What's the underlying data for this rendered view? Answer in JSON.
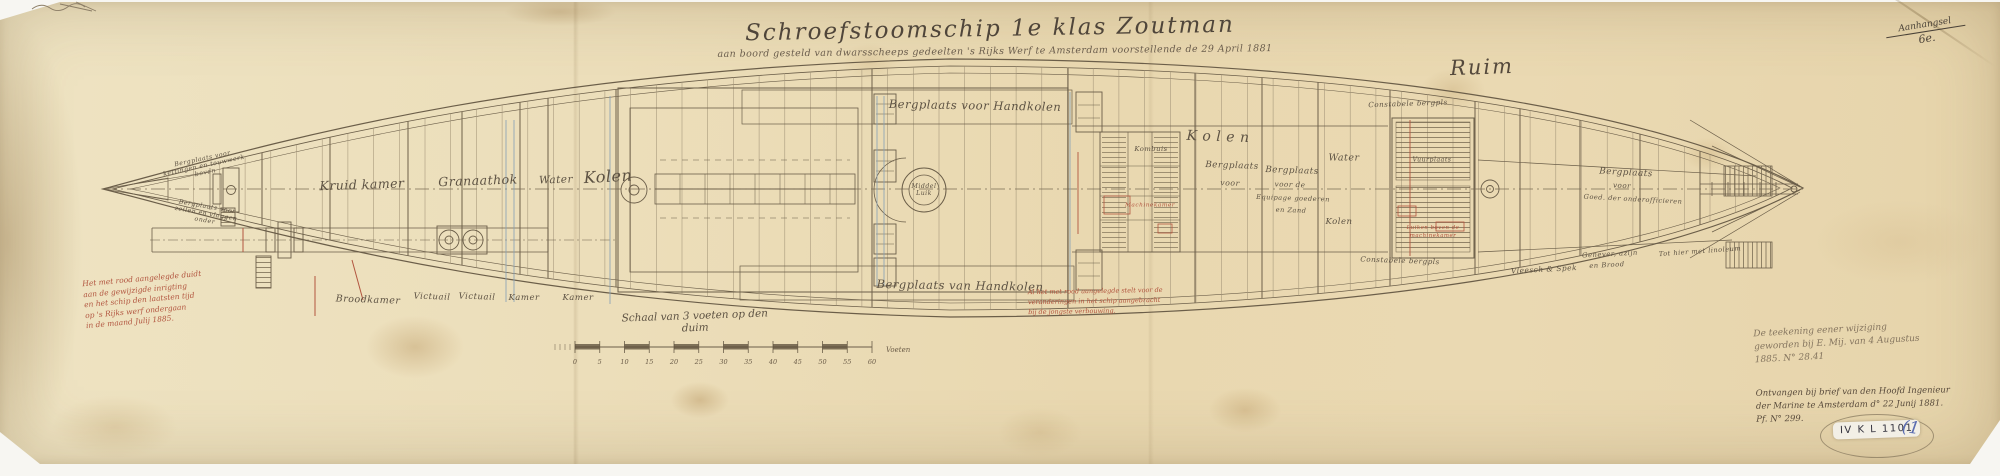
{
  "header": {
    "title": "Schroefstoomschip 1e klas Zoutman",
    "subtitle": "aan boord gesteld van dwarsscheeps gedeelten 's Rijks Werf te Amsterdam voorstellende de 29 April 1881",
    "corner_note": [
      "Aanhangsel",
      "6e."
    ],
    "hold_label": "Ruim"
  },
  "plan": {
    "labels": [
      {
        "text": "Bergplaats voor\nkettingen en touwwerk\nboven",
        "x": 204,
        "y": 166,
        "s": 6.2,
        "r": -12
      },
      {
        "text": "Bergplaats voor\nzeilen en vlaggen\nonder",
        "x": 206,
        "y": 214,
        "s": 6.2,
        "r": 10
      },
      {
        "text": "Kruid kamer",
        "x": 362,
        "y": 185,
        "s": 12.5,
        "r": -2
      },
      {
        "text": "Granaathok",
        "x": 478,
        "y": 181,
        "s": 12.5,
        "r": -2
      },
      {
        "text": "Water",
        "x": 556,
        "y": 180,
        "s": 10.5,
        "r": -2
      },
      {
        "text": "Kolen",
        "x": 608,
        "y": 177,
        "s": 16,
        "r": -3
      },
      {
        "text": "Broodkamer",
        "x": 368,
        "y": 301,
        "s": 9.5,
        "r": 2
      },
      {
        "text": "Victuail",
        "x": 432,
        "y": 298,
        "s": 8.5,
        "r": 2
      },
      {
        "text": "Victuail",
        "x": 477,
        "y": 298,
        "s": 8.5,
        "r": 2
      },
      {
        "text": "Kamer",
        "x": 524,
        "y": 299,
        "s": 8.5,
        "r": 0
      },
      {
        "text": "Kamer",
        "x": 578,
        "y": 299,
        "s": 8.5,
        "r": 0
      },
      {
        "text": "Bergplaats voor Handkolen",
        "x": 975,
        "y": 106,
        "s": 11.5,
        "r": 1
      },
      {
        "text": "Bergplaats van Handkolen",
        "x": 960,
        "y": 286,
        "s": 11.5,
        "r": 1
      },
      {
        "text": "Middel\nLuik",
        "x": 924,
        "y": 190,
        "s": 6.2,
        "r": 0
      },
      {
        "text": "K o l e n",
        "x": 1218,
        "y": 137,
        "s": 14,
        "r": 2
      },
      {
        "text": "Water",
        "x": 1344,
        "y": 159,
        "s": 9.5,
        "r": 0
      },
      {
        "text": "Kolen",
        "x": 1339,
        "y": 223,
        "s": 8.5,
        "r": 0
      },
      {
        "text": "Constabele bergpls",
        "x": 1408,
        "y": 104,
        "s": 7.2,
        "r": -2
      },
      {
        "text": "Constabele bergpls",
        "x": 1400,
        "y": 261,
        "s": 7.2,
        "r": 2
      },
      {
        "text": "Kombuis",
        "x": 1151,
        "y": 150,
        "s": 6.8,
        "r": 0
      },
      {
        "text": "Machinekamer",
        "x": 1150,
        "y": 206,
        "s": 5.8,
        "r": 0,
        "c": "#b2553f"
      },
      {
        "text": "Bergplaats",
        "x": 1232,
        "y": 166,
        "s": 8.8,
        "r": 2
      },
      {
        "text": "voor",
        "x": 1230,
        "y": 184,
        "s": 7.8,
        "r": 2
      },
      {
        "text": "Bergplaats",
        "x": 1292,
        "y": 171,
        "s": 8.8,
        "r": 2
      },
      {
        "text": "voor de",
        "x": 1290,
        "y": 185,
        "s": 7.2,
        "r": 2
      },
      {
        "text": "Equipage goederen",
        "x": 1293,
        "y": 199,
        "s": 6.6,
        "r": 2
      },
      {
        "text": "en Zand",
        "x": 1291,
        "y": 211,
        "s": 6.6,
        "r": 2
      },
      {
        "text": "Bergplaats",
        "x": 1626,
        "y": 173,
        "s": 8.8,
        "r": 3
      },
      {
        "text": "voor",
        "x": 1622,
        "y": 186,
        "s": 7.2,
        "r": 3
      },
      {
        "text": "Goed. der onderofficieren",
        "x": 1633,
        "y": 200,
        "s": 6.6,
        "r": 3
      },
      {
        "text": "Genever, azijn",
        "x": 1610,
        "y": 255,
        "s": 6.8,
        "r": -3
      },
      {
        "text": "en Brood",
        "x": 1607,
        "y": 266,
        "s": 6.8,
        "r": -3
      },
      {
        "text": "Vleesch & Spek",
        "x": 1544,
        "y": 270,
        "s": 7.4,
        "r": -3
      },
      {
        "text": "Tot hier met linoleum",
        "x": 1700,
        "y": 252,
        "s": 6.6,
        "r": -4
      },
      {
        "text": "Vuurplaats",
        "x": 1432,
        "y": 160,
        "s": 6.2,
        "r": 0
      },
      {
        "text": "Luiken boven de",
        "x": 1433,
        "y": 228,
        "s": 5.4,
        "r": 0,
        "c": "#b2553f"
      },
      {
        "text": "machinekamer",
        "x": 1433,
        "y": 236,
        "s": 5.4,
        "r": 0,
        "c": "#b2553f"
      }
    ]
  },
  "notes": {
    "left_red": {
      "lines": [
        "Het met rood aangelegde duidt",
        "aan de gewijzigde inrigting",
        "en het schip den laatsten tijd",
        "op 's Rijks werf ondergaan",
        "in de maand Julij 1885."
      ]
    },
    "center_red": {
      "lines": [
        "Al het met rood aangelegde stelt voor de",
        "veranderingen in het schip aangebracht",
        "bij de jongste verbouwing."
      ]
    },
    "right_pencil": {
      "lines": [
        "De teekening eener wijziging",
        "geworden bij E. Mij. van 4 Augustus",
        "1885.   N° 28.41"
      ]
    },
    "right_ink": {
      "lines": [
        "Ontvangen bij brief van den Hoofd Ingenieur",
        "der Marine te Amsterdam  d° 22 Junij 1881.",
        "Pf.   N° 299."
      ]
    },
    "sticker": "IV K L 1101",
    "blue_mark": "(1"
  },
  "scale_bar": {
    "label": "Schaal van 3 voeten op den duim",
    "ticks": [
      "0",
      "5",
      "10",
      "15",
      "20",
      "25",
      "30",
      "35",
      "40",
      "45",
      "50",
      "55",
      "60"
    ],
    "unit": "Voeten"
  }
}
